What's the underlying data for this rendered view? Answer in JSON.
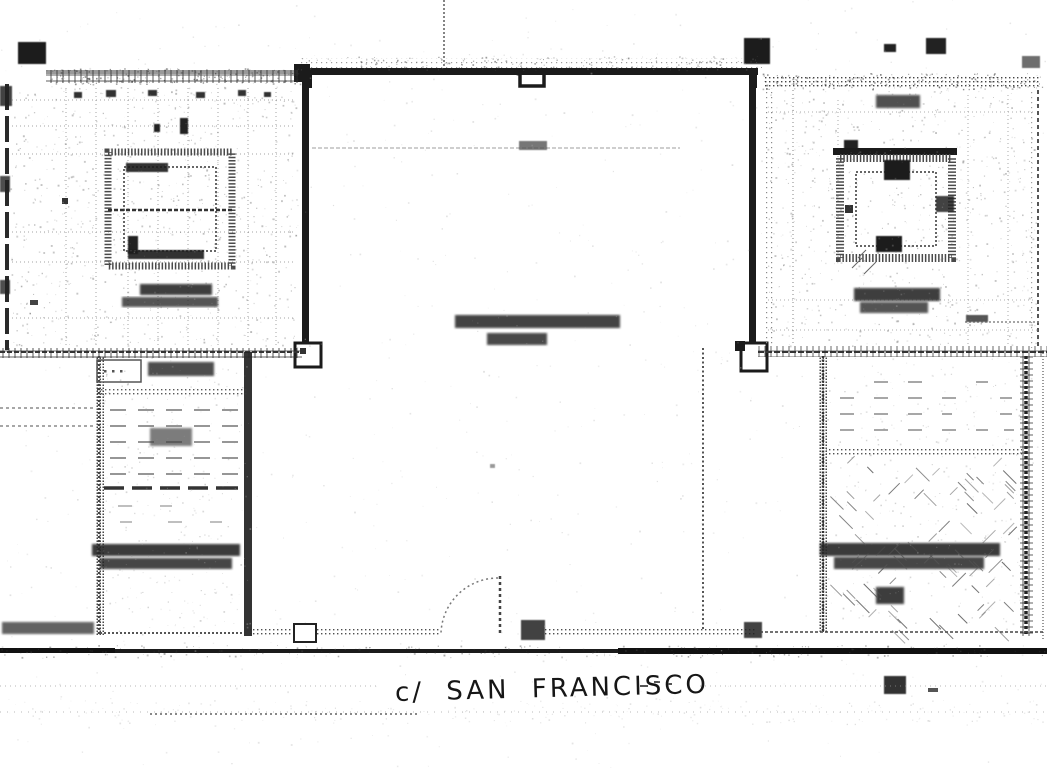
{
  "document": {
    "kind": "scanned-floor-plan"
  },
  "labels": {
    "street": "c/ SAN FRANCISCO"
  },
  "colors": {
    "ink": "#1b1b1b",
    "paper": "#ffffff",
    "faint_grid": "#999999",
    "smudge": "#2b2b2b"
  }
}
